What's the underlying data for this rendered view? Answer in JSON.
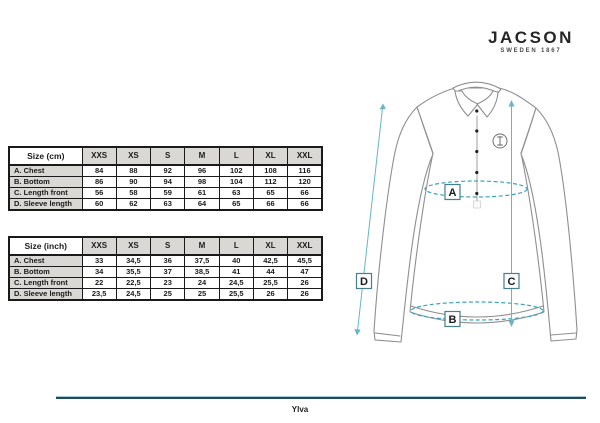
{
  "brand": {
    "name": "JACSON",
    "tagline": "SWEDEN 1867"
  },
  "tables": [
    {
      "title": "Size (cm)",
      "columns": [
        "XXS",
        "XS",
        "S",
        "M",
        "L",
        "XL",
        "XXL"
      ],
      "rows": [
        {
          "label": "A. Chest",
          "values": [
            "84",
            "88",
            "92",
            "96",
            "102",
            "108",
            "116"
          ]
        },
        {
          "label": "B. Bottom",
          "values": [
            "86",
            "90",
            "94",
            "98",
            "104",
            "112",
            "120"
          ]
        },
        {
          "label": "C. Length front",
          "values": [
            "56",
            "58",
            "59",
            "61",
            "63",
            "65",
            "66"
          ]
        },
        {
          "label": "D. Sleeve length",
          "values": [
            "60",
            "62",
            "63",
            "64",
            "65",
            "66",
            "66"
          ]
        }
      ]
    },
    {
      "title": "Size (inch)",
      "columns": [
        "XXS",
        "XS",
        "S",
        "M",
        "L",
        "XL",
        "XXL"
      ],
      "rows": [
        {
          "label": "A. Chest",
          "values": [
            "33",
            "34,5",
            "36",
            "37,5",
            "40",
            "42,5",
            "45,5"
          ]
        },
        {
          "label": "B. Bottom",
          "values": [
            "34",
            "35,5",
            "37",
            "38,5",
            "41",
            "44",
            "47"
          ]
        },
        {
          "label": "C. Length front",
          "values": [
            "22",
            "22,5",
            "23",
            "24",
            "24,5",
            "25,5",
            "26"
          ]
        },
        {
          "label": "D. Sleeve length",
          "values": [
            "23,5",
            "24,5",
            "25",
            "25",
            "25,5",
            "26",
            "26"
          ]
        }
      ]
    }
  ],
  "diagram": {
    "labels": {
      "chest": "A",
      "bottom": "B",
      "length_front": "C",
      "sleeve_length": "D"
    },
    "accent_color": "#3aa5ba",
    "arrow_color": "#63b7c6",
    "outline_color": "#8f8f8f"
  },
  "footer": {
    "product_name": "Ylva",
    "line_color": "#1d4a5e"
  }
}
